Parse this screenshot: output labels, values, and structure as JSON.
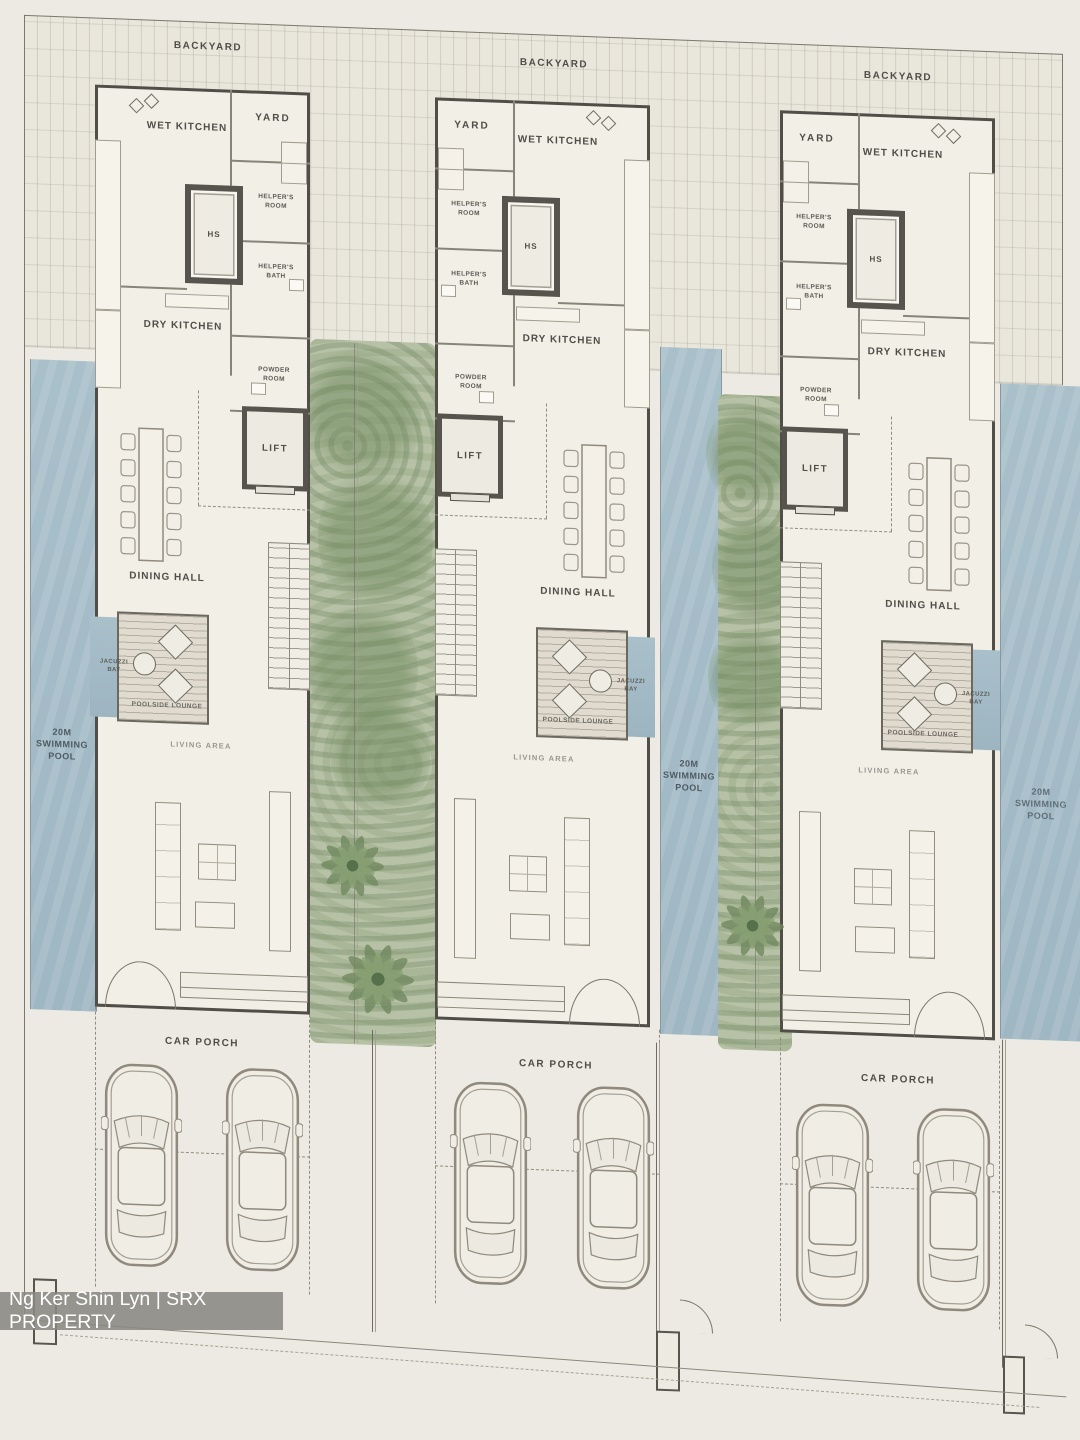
{
  "watermark": {
    "text": "Ng Ker Shin Lyn | SRX PROPERTY"
  },
  "pools": [
    {
      "label": "20M SWIMMING POOL"
    },
    {
      "label": "20M SWIMMING POOL"
    },
    {
      "label": "20M SWIMMING POOL"
    }
  ],
  "units": [
    {
      "name": "unit-1",
      "rooms": {
        "backyard": "BACKYARD",
        "wet_kitchen": "WET KITCHEN",
        "yard": "YARD",
        "helpers_room": "HELPER'S ROOM",
        "hs": "HS",
        "helpers_bath": "HELPER'S BATH",
        "dry_kitchen": "DRY KITCHEN",
        "powder_room": "POWDER ROOM",
        "lift": "LIFT",
        "dining_hall": "DINING HALL",
        "jacuzzi_bay": "JACUZZI BAY",
        "poolside_lounge": "POOLSIDE LOUNGE",
        "living_area": "LIVING AREA",
        "car_porch": "CAR PORCH"
      }
    },
    {
      "name": "unit-2",
      "rooms": {
        "backyard": "BACKYARD",
        "wet_kitchen": "WET KITCHEN",
        "yard": "YARD",
        "helpers_room": "HELPER'S ROOM",
        "hs": "HS",
        "helpers_bath": "HELPER'S BATH",
        "dry_kitchen": "DRY KITCHEN",
        "powder_room": "POWDER ROOM",
        "lift": "LIFT",
        "dining_hall": "DINING HALL",
        "jacuzzi_bay": "JACUZZI BAY",
        "poolside_lounge": "POOLSIDE LOUNGE",
        "living_area": "LIVING AREA",
        "car_porch": "CAR PORCH"
      }
    },
    {
      "name": "unit-3",
      "rooms": {
        "backyard": "BACKYARD",
        "wet_kitchen": "WET KITCHEN",
        "yard": "YARD",
        "helpers_room": "HELPER'S ROOM",
        "hs": "HS",
        "helpers_bath": "HELPER'S BATH",
        "dry_kitchen": "DRY KITCHEN",
        "powder_room": "POWDER ROOM",
        "lift": "LIFT",
        "dining_hall": "DINING HALL",
        "jacuzzi_bay": "JACUZZI BAY",
        "poolside_lounge": "POOLSIDE LOUNGE",
        "living_area": "LIVING AREA",
        "car_porch": "CAR PORCH"
      }
    }
  ],
  "colors": {
    "paper": "#ECEAE2",
    "wall": "#504E47",
    "pool": "#A7BFCB",
    "greenery": "#B6C1A6",
    "deck": "#E0DBCE",
    "watermark_bg": "#898883",
    "label_text": "#504E47"
  }
}
